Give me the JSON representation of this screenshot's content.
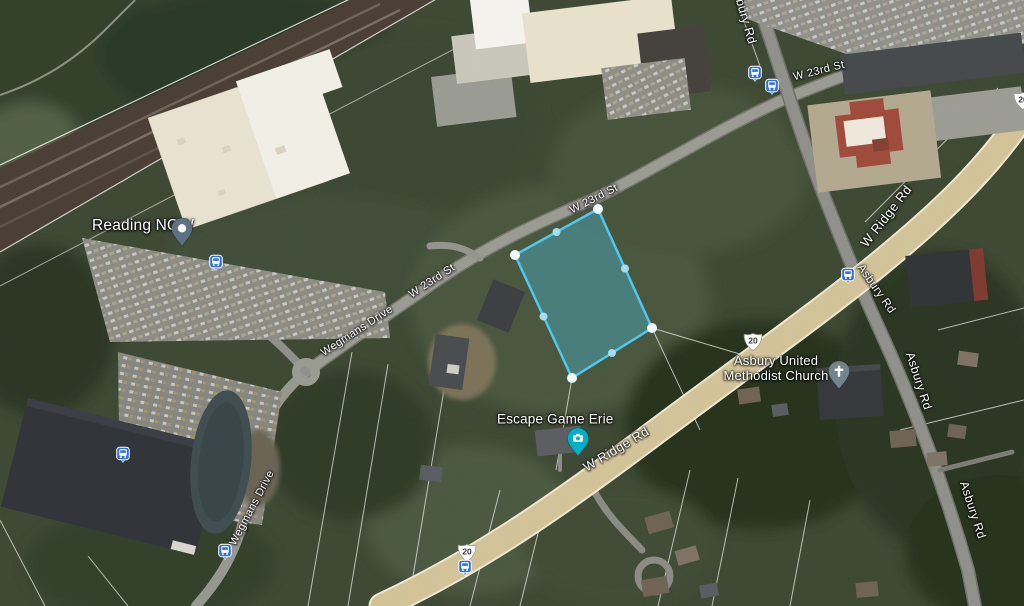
{
  "map": {
    "labels": {
      "reading_now": "Reading NOW",
      "escape_game_erie": "Escape Game Erie",
      "church_line1": "Asbury United",
      "church_line2": "Methodist Church"
    },
    "roads": {
      "w_23rd_st": "W 23rd St",
      "wegmans_drive": "Wegmans Drive",
      "w_ridge_rd": "W Ridge Rd",
      "asbury_rd": "Asbury Rd"
    },
    "shields": {
      "us_20": "20"
    }
  },
  "parcel": {
    "points": "515,255 598,209 652,328 572,378",
    "corners": [
      [
        515,
        255
      ],
      [
        598,
        209
      ],
      [
        652,
        328
      ],
      [
        572,
        378
      ]
    ],
    "midpoints": [
      [
        556.5,
        232
      ],
      [
        625,
        268.5
      ],
      [
        612,
        353
      ],
      [
        543.5,
        316.5
      ]
    ],
    "stroke": "#4fc7ee",
    "fill": "rgba(72,198,240,0.34)"
  },
  "colors": {
    "transit_blue": "#2f6fe0",
    "shield_fill": "#fbfbf9",
    "pin_grey": "#5d7283",
    "pin_teal": "#00b1c6",
    "church_pin_grey": "#72858f"
  }
}
